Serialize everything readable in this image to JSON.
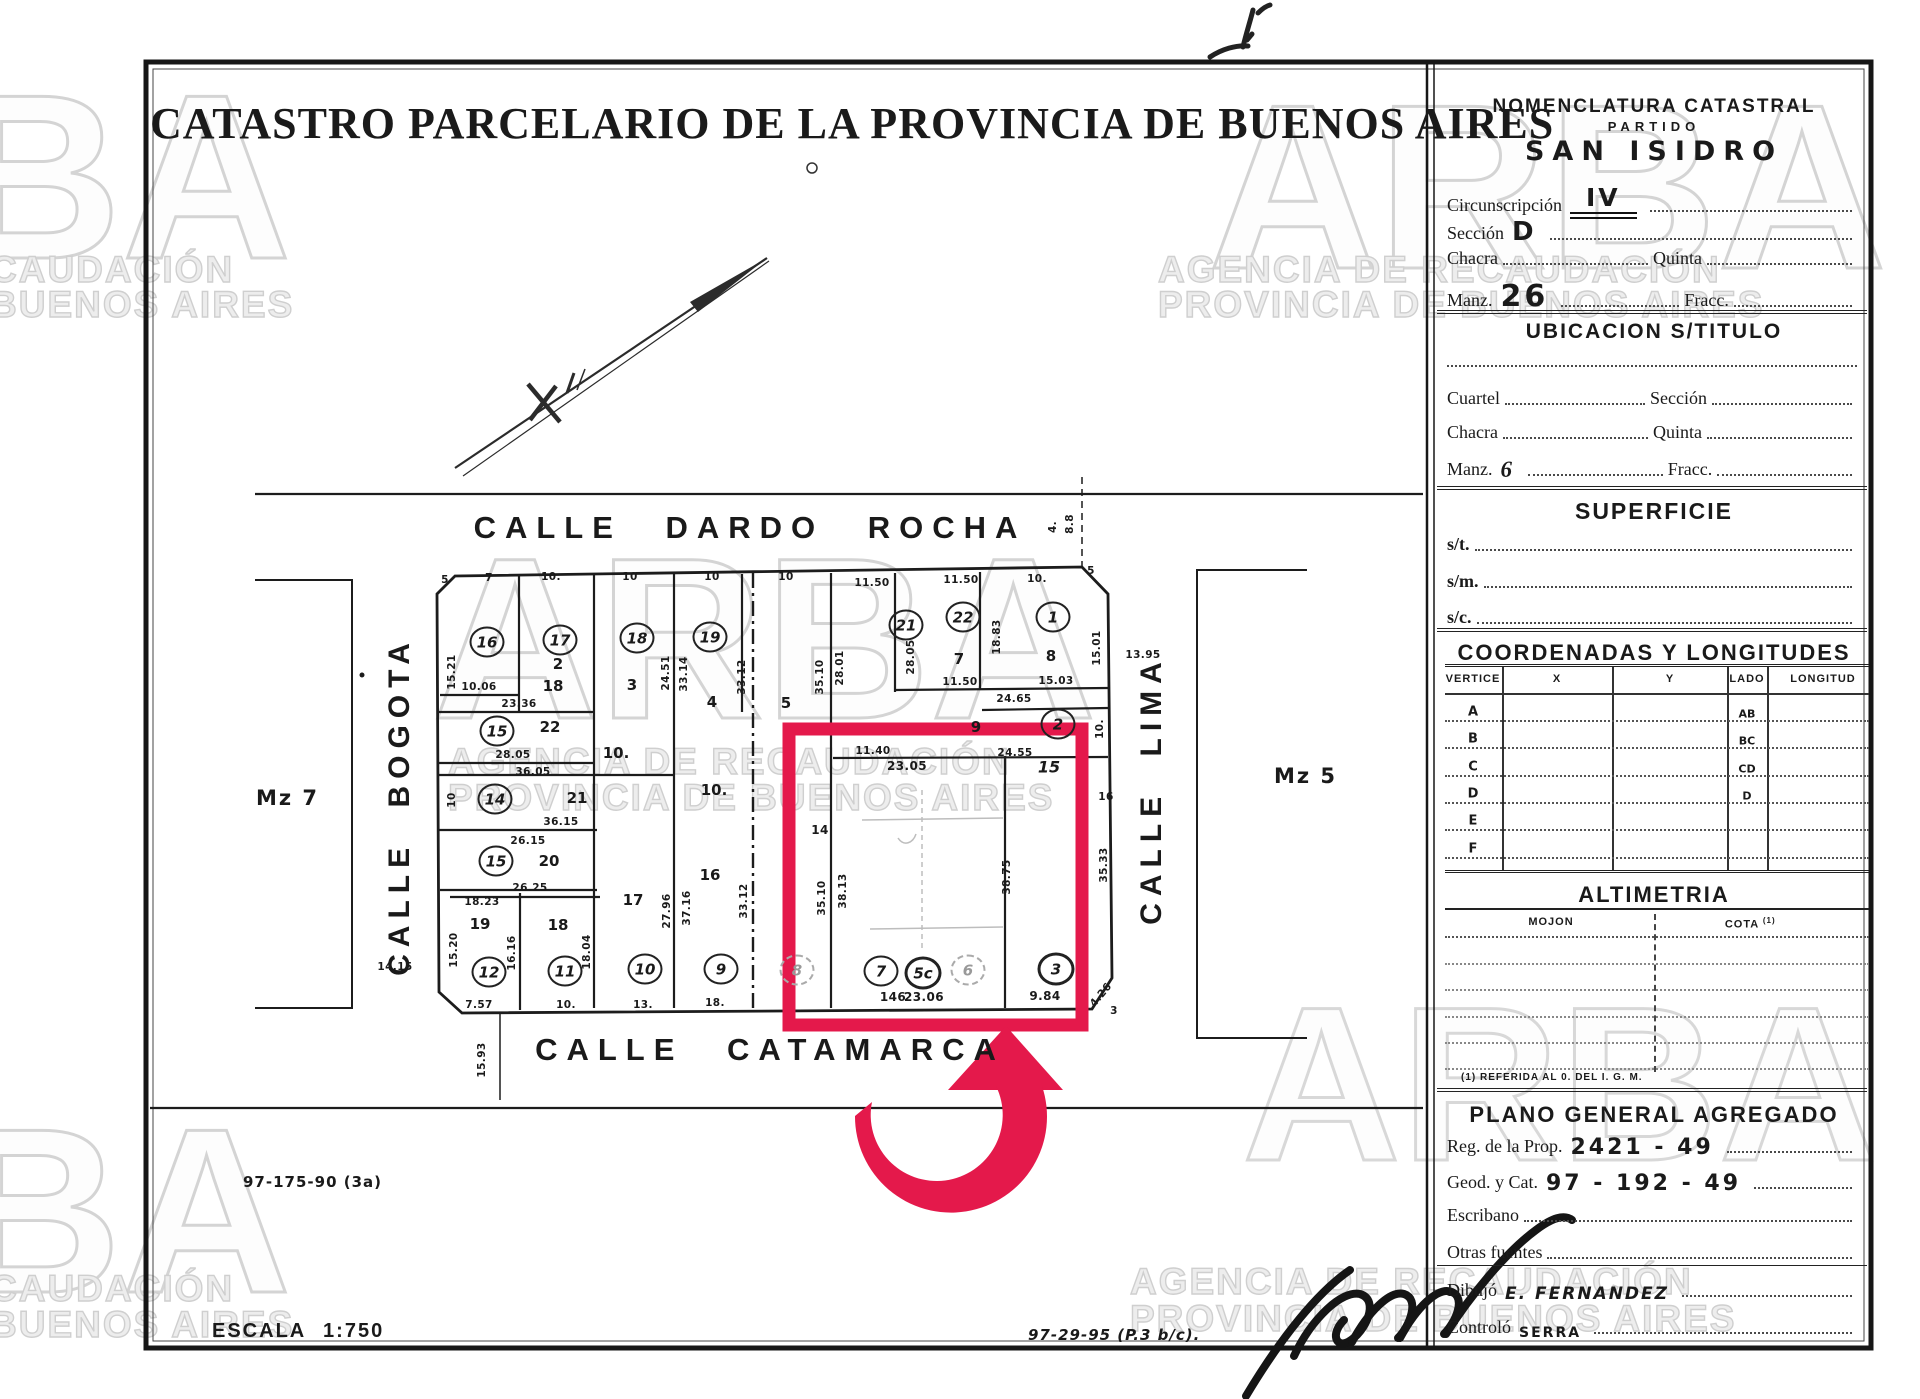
{
  "colors": {
    "highlight": "#e4194b",
    "ink": "#1a1a1a",
    "watermark_stroke": "#d4d4d4"
  },
  "watermark": {
    "brand": "ARBA",
    "brand_partial": "BA",
    "agency_line": "AGENCIA DE RECAUDACIÓN",
    "province_line": "PROVINCIA DE BUENOS AIRES",
    "agency_partial": "CAUDACIÓN",
    "province_partial": "BUENOS AIRES"
  },
  "document": {
    "title": "CATASTRO PARCELARIO DE LA PROVINCIA DE BUENOS AIRES"
  },
  "map": {
    "streets": {
      "top": "CALLE DARDO ROCHA",
      "bottom": "CALLE CATAMARCA",
      "left": "CALLE BOGOTA",
      "right": "CALLE LIMA"
    },
    "adjacent_blocks": {
      "left": "Mz 7",
      "right": "Mz 5"
    },
    "scale_label": "ESCALA 1:750",
    "plan_ref_left": "97-175-90 (3a)",
    "plan_ref_bottom": "97-29-95 (P.3 b/c).",
    "parcels": [
      {
        "n": "16",
        "x": 487,
        "y": 642
      },
      {
        "n": "17",
        "x": 560,
        "y": 640
      },
      {
        "n": "18",
        "x": 637,
        "y": 638
      },
      {
        "n": "19",
        "x": 710,
        "y": 637
      },
      {
        "n": "21",
        "x": 906,
        "y": 625
      },
      {
        "n": "22",
        "x": 963,
        "y": 617
      },
      {
        "n": "1",
        "x": 1053,
        "y": 617
      },
      {
        "n": "2",
        "x": 1058,
        "y": 724
      },
      {
        "n": "15",
        "x": 497,
        "y": 731
      },
      {
        "n": "14",
        "x": 495,
        "y": 799
      },
      {
        "n": "15",
        "x": 496,
        "y": 861
      },
      {
        "n": "12",
        "x": 489,
        "y": 972
      },
      {
        "n": "11",
        "x": 565,
        "y": 971
      },
      {
        "n": "10",
        "x": 645,
        "y": 969
      },
      {
        "n": "9",
        "x": 721,
        "y": 969
      },
      {
        "n": "8",
        "x": 797,
        "y": 970,
        "s": "faint"
      },
      {
        "n": "7",
        "x": 881,
        "y": 971
      },
      {
        "n": "5c",
        "x": 923,
        "y": 973,
        "s": "bold"
      },
      {
        "n": "6",
        "x": 968,
        "y": 970,
        "s": "faint"
      },
      {
        "n": "3",
        "x": 1056,
        "y": 969,
        "s": "bold"
      }
    ],
    "lots": [
      {
        "t": "2",
        "x": 558,
        "y": 664
      },
      {
        "t": "18",
        "x": 553,
        "y": 686
      },
      {
        "t": "3",
        "x": 632,
        "y": 685
      },
      {
        "t": "4",
        "x": 712,
        "y": 702
      },
      {
        "t": "5",
        "x": 786,
        "y": 703
      },
      {
        "t": "7",
        "x": 959,
        "y": 659
      },
      {
        "t": "8",
        "x": 1051,
        "y": 656
      },
      {
        "t": "9",
        "x": 976,
        "y": 727
      },
      {
        "t": "22",
        "x": 550,
        "y": 727
      },
      {
        "t": "20",
        "x": 549,
        "y": 861
      },
      {
        "t": "21",
        "x": 577,
        "y": 798
      },
      {
        "t": "19",
        "x": 480,
        "y": 924
      },
      {
        "t": "18",
        "x": 558,
        "y": 925
      },
      {
        "t": "17",
        "x": 633,
        "y": 900
      },
      {
        "t": "16",
        "x": 710,
        "y": 875
      },
      {
        "t": "15",
        "x": 1049,
        "y": 767,
        "b": 1
      },
      {
        "t": "10.",
        "x": 616,
        "y": 753
      },
      {
        "t": "10.",
        "x": 714,
        "y": 790
      }
    ],
    "dims": [
      {
        "t": "7",
        "x": 489,
        "y": 578
      },
      {
        "t": "10.",
        "x": 551,
        "y": 577
      },
      {
        "t": "10",
        "x": 630,
        "y": 577
      },
      {
        "t": "10",
        "x": 712,
        "y": 577
      },
      {
        "t": "10",
        "x": 786,
        "y": 577
      },
      {
        "t": "11.50",
        "x": 872,
        "y": 583
      },
      {
        "t": "11.50",
        "x": 961,
        "y": 580
      },
      {
        "t": "10.",
        "x": 1037,
        "y": 579
      },
      {
        "t": "15.21",
        "x": 452,
        "y": 672,
        "r": -90
      },
      {
        "t": "10.06",
        "x": 479,
        "y": 687
      },
      {
        "t": "23.36",
        "x": 519,
        "y": 704
      },
      {
        "t": "28.05",
        "x": 513,
        "y": 755
      },
      {
        "t": "36.05",
        "x": 533,
        "y": 772
      },
      {
        "t": "36.15",
        "x": 561,
        "y": 822
      },
      {
        "t": "26.15",
        "x": 528,
        "y": 841
      },
      {
        "t": "26.25",
        "x": 530,
        "y": 888
      },
      {
        "t": "18.23",
        "x": 482,
        "y": 902
      },
      {
        "t": "15.20",
        "x": 454,
        "y": 950,
        "r": -90
      },
      {
        "t": "10",
        "x": 452,
        "y": 800,
        "r": -90
      },
      {
        "t": "7.57",
        "x": 479,
        "y": 1005
      },
      {
        "t": "10.",
        "x": 566,
        "y": 1005
      },
      {
        "t": "13.",
        "x": 643,
        "y": 1005
      },
      {
        "t": "18.",
        "x": 715,
        "y": 1003
      },
      {
        "t": "146",
        "x": 893,
        "y": 997,
        "b": 1
      },
      {
        "t": "23.06",
        "x": 924,
        "y": 997,
        "b": 1
      },
      {
        "t": "9.84",
        "x": 1045,
        "y": 996,
        "b": 1
      },
      {
        "t": "4.26",
        "x": 1101,
        "y": 995,
        "r": -50
      },
      {
        "t": "3",
        "x": 1114,
        "y": 1011
      },
      {
        "t": "15.93",
        "x": 482,
        "y": 1060,
        "r": -90
      },
      {
        "t": "24.51",
        "x": 666,
        "y": 673,
        "r": -90
      },
      {
        "t": "33.14",
        "x": 684,
        "y": 674,
        "r": -90
      },
      {
        "t": "33.12",
        "x": 742,
        "y": 677,
        "r": -90
      },
      {
        "t": "35.10",
        "x": 820,
        "y": 677,
        "r": -90
      },
      {
        "t": "28.01",
        "x": 840,
        "y": 668,
        "r": -90
      },
      {
        "t": "28.05",
        "x": 911,
        "y": 657,
        "r": -90
      },
      {
        "t": "18.83",
        "x": 997,
        "y": 637,
        "r": -90
      },
      {
        "t": "15.01",
        "x": 1097,
        "y": 648,
        "r": -90
      },
      {
        "t": "27.96",
        "x": 667,
        "y": 911,
        "r": -90
      },
      {
        "t": "37.16",
        "x": 687,
        "y": 908,
        "r": -90
      },
      {
        "t": "33.12",
        "x": 744,
        "y": 901,
        "r": -90
      },
      {
        "t": "16.16",
        "x": 512,
        "y": 953,
        "r": -90
      },
      {
        "t": "18.04",
        "x": 587,
        "y": 952,
        "r": -90
      },
      {
        "t": "38.75",
        "x": 1007,
        "y": 877,
        "r": -90
      },
      {
        "t": "35.10",
        "x": 822,
        "y": 898,
        "r": -90
      },
      {
        "t": "38.13",
        "x": 843,
        "y": 891,
        "r": -90
      },
      {
        "t": "15.03",
        "x": 1056,
        "y": 681
      },
      {
        "t": "11.50",
        "x": 960,
        "y": 682
      },
      {
        "t": "24.65",
        "x": 1014,
        "y": 699
      },
      {
        "t": "24.55",
        "x": 1015,
        "y": 753
      },
      {
        "t": "11.40",
        "x": 873,
        "y": 751
      },
      {
        "t": "23.05",
        "x": 907,
        "y": 766,
        "b": 1
      },
      {
        "t": "35.33",
        "x": 1104,
        "y": 865,
        "r": -90
      },
      {
        "t": "10.",
        "x": 1100,
        "y": 729,
        "r": -90
      },
      {
        "t": "16",
        "x": 1106,
        "y": 797
      },
      {
        "t": "13.95",
        "x": 1143,
        "y": 655
      },
      {
        "t": "14.15",
        "x": 395,
        "y": 967
      },
      {
        "t": "4.",
        "x": 1053,
        "y": 527,
        "r": -90
      },
      {
        "t": "8.8",
        "x": 1070,
        "y": 524,
        "r": -90
      },
      {
        "t": "14",
        "x": 820,
        "y": 830,
        "b": 1
      },
      {
        "t": "5",
        "x": 445,
        "y": 580
      },
      {
        "t": "5",
        "x": 1091,
        "y": 571
      }
    ]
  },
  "panel": {
    "nomenclatura": {
      "title": "NOMENCLATURA CATASTRAL",
      "partido_label": "PARTIDO",
      "partido_value": "SAN ISIDRO",
      "circunscripcion_label": "Circunscripción",
      "circunscripcion_value": "IV",
      "seccion_label": "Sección",
      "seccion_value": "D",
      "chacra_label": "Chacra",
      "quinta_label": "Quinta",
      "manzana_label": "Manz.",
      "manzana_value": "26",
      "fraccion_label": "Fracc."
    },
    "ubicacion": {
      "title": "UBICACION S/TITULO",
      "cuartel_label": "Cuartel",
      "seccion_label": "Sección",
      "chacra_label": "Chacra",
      "quinta_label": "Quinta",
      "manzana_label": "Manz.",
      "manzana_value": "6",
      "fraccion_label": "Fracc."
    },
    "superficie": {
      "title": "SUPERFICIE",
      "rows": [
        "s/t.",
        "s/m.",
        "s/c."
      ]
    },
    "coordenadas": {
      "title": "COORDENADAS Y LONGITUDES",
      "headers": [
        "VERTICE",
        "X",
        "Y",
        "LADO",
        "LONGITUD"
      ],
      "vertices": [
        "A",
        "B",
        "C",
        "D",
        "E",
        "F"
      ],
      "lados": [
        "AB",
        "BC",
        "CD",
        "D"
      ]
    },
    "altimetria": {
      "title": "ALTIMETRIA",
      "col_mojon": "MOJON",
      "col_cota": "COTA",
      "cota_sup": "(1)",
      "footnote": "(1) REFERIDA AL 0. DEL I. G. M."
    },
    "plano": {
      "title": "PLANO GENERAL AGREGADO",
      "reg_label": "Reg. de la Prop.",
      "reg_value": "2421 - 49",
      "geod_label": "Geod. y Cat.",
      "geod_value": "97 - 192 - 49",
      "escribano_label": "Escribano",
      "otras_label": "Otras fuentes",
      "dibujo_label": "Dibujó",
      "dibujo_value": "E. FERNANDEZ",
      "controlo_label": "Controló",
      "controlo_value": "SERRA"
    }
  }
}
